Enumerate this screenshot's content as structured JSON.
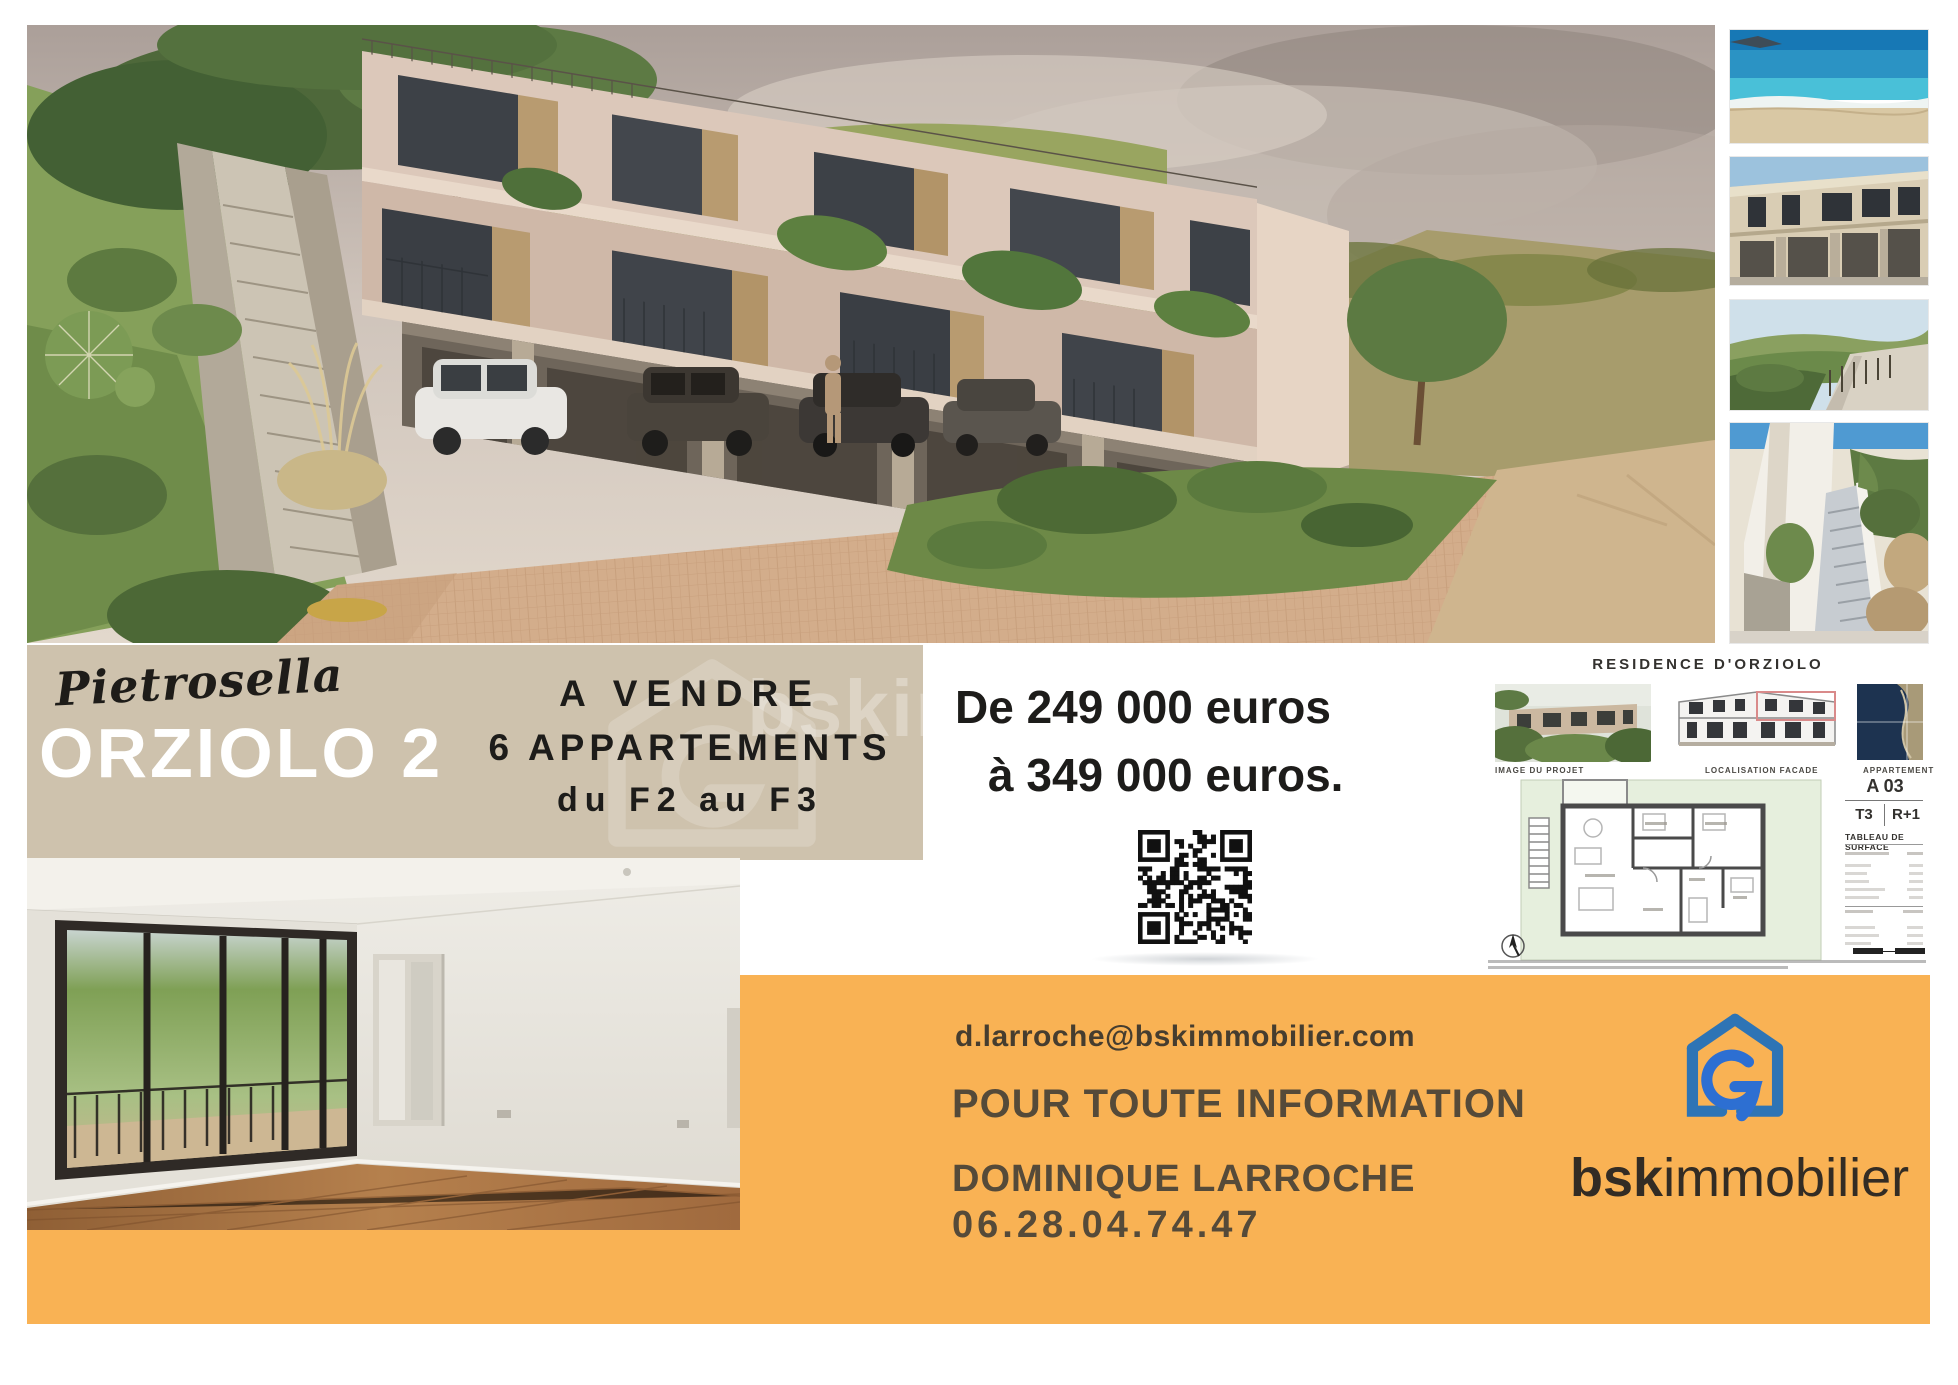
{
  "band": {
    "location": "Pietrosella",
    "title": "ORZIOLO 2",
    "sale_line1": "A VENDRE",
    "sale_line2": "6 APPARTEMENTS",
    "sale_line3": "du F2 au F3",
    "watermark": "bskimmobilier"
  },
  "price": {
    "line1": "De 249 000 euros",
    "line2": "à 349 000 euros."
  },
  "plan_doc": {
    "title": "RESIDENCE D'ORZIOLO",
    "label_image": "IMAGE DU PROJET",
    "label_facade": "LOCALISATION FACADE",
    "label_apartment": "APPARTEMENT",
    "apartment_code": "A 03",
    "type": "T3",
    "floor": "R+1",
    "table_title": "TABLEAU DE SURFACE"
  },
  "contact": {
    "email": "d.larroche@bskimmobilier.com",
    "heading": "POUR TOUTE INFORMATION",
    "name": "DOMINIQUE LARROCHE",
    "phone": "06.28.04.74.47"
  },
  "brand": {
    "bold": "bsk",
    "rest": "immobilier"
  },
  "colors": {
    "beige_band": "#cec2ad",
    "orange_band": "#f9b254",
    "brand_blue": "#2e74b5",
    "brand_blue_accent": "#2d6fd2",
    "headline_text": "#1d1c1a",
    "contact_text": "#554a39"
  }
}
